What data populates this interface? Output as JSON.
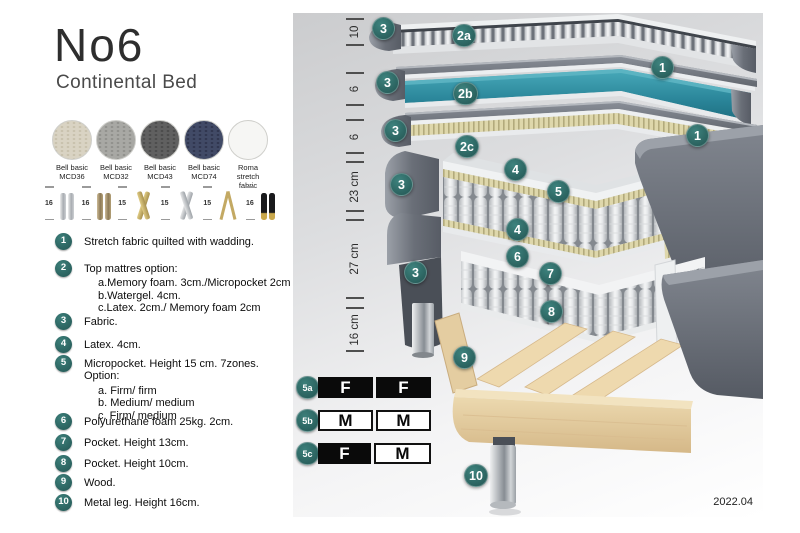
{
  "header": {
    "title": "No6",
    "subtitle": "Continental Bed"
  },
  "fabrics": [
    {
      "line1": "Bell basic",
      "line2": "MCD36",
      "color": "#d9d3c3"
    },
    {
      "line1": "Bell basic",
      "line2": "MCD32",
      "color": "#a8a8a4"
    },
    {
      "line1": "Bell basic",
      "line2": "MCD43",
      "color": "#606060"
    },
    {
      "line1": "Bell basic",
      "line2": "MCD74",
      "color": "#414a66"
    },
    {
      "line1": "Roma",
      "line2": "stretch fabric",
      "color": "#f6f6f4"
    }
  ],
  "legs": [
    {
      "height": "16",
      "type": "cylinder-silver"
    },
    {
      "height": "16",
      "type": "cylinder-bronze"
    },
    {
      "height": "15",
      "type": "cross-gold"
    },
    {
      "height": "15",
      "type": "cross-silver"
    },
    {
      "height": "15",
      "type": "hairpin-gold"
    },
    {
      "height": "16",
      "type": "tapered-black-gold"
    }
  ],
  "features": {
    "items": [
      {
        "num": "1",
        "text": "Stretch fabric quilted with wadding."
      },
      {
        "num": "2",
        "text": "Top mattres option:",
        "options": [
          "a.Memory foam. 3cm./Micropocket 2cm",
          "b.Watergel. 4cm.",
          "c.Latex. 2cm./ Memory foam 2cm"
        ]
      },
      {
        "num": "3",
        "text": "Fabric."
      },
      {
        "num": "4",
        "text": "Latex. 4cm."
      },
      {
        "num": "5",
        "text": "Micropocket. Height 15 cm. 7zones. Option:",
        "options": [
          "a. Firm/ firm",
          "b. Medium/ medium",
          "c. Firm/ medium"
        ]
      },
      {
        "num": "6",
        "text": "Polyurethane foam 25kg. 2cm."
      },
      {
        "num": "7",
        "text": "Pocket. Height 13cm."
      },
      {
        "num": "8",
        "text": "Pocket. Height 10cm."
      },
      {
        "num": "9",
        "text": "Wood."
      },
      {
        "num": "10",
        "text": "Metal leg. Height 16cm."
      }
    ]
  },
  "diagram": {
    "dimensions": [
      {
        "label": "10"
      },
      {
        "label": "6"
      },
      {
        "label": "6"
      },
      {
        "label": "23 cm"
      },
      {
        "label": "27 cm"
      },
      {
        "label": "16 cm"
      }
    ],
    "badges": [
      {
        "id": "fabric-top",
        "label": "3"
      },
      {
        "id": "top-option-a",
        "label": "2a"
      },
      {
        "id": "stretch-cover-a",
        "label": "1"
      },
      {
        "id": "fabric-mid",
        "label": "3"
      },
      {
        "id": "top-option-b",
        "label": "2b"
      },
      {
        "id": "stretch-cover-b",
        "label": "1"
      },
      {
        "id": "fabric-low",
        "label": "3"
      },
      {
        "id": "top-option-c",
        "label": "2c"
      },
      {
        "id": "latex-top",
        "label": "4"
      },
      {
        "id": "micropocket",
        "label": "5"
      },
      {
        "id": "fabric-23",
        "label": "3"
      },
      {
        "id": "latex-bottom",
        "label": "4"
      },
      {
        "id": "pu-foam",
        "label": "6"
      },
      {
        "id": "pocket-13",
        "label": "7"
      },
      {
        "id": "fabric-27",
        "label": "3"
      },
      {
        "id": "pocket-10",
        "label": "8"
      },
      {
        "id": "wood",
        "label": "9"
      },
      {
        "id": "metal-leg",
        "label": "10"
      }
    ]
  },
  "firmness": {
    "rows": [
      {
        "label": "5a",
        "cells": [
          {
            "value": "F",
            "style": "dark"
          },
          {
            "value": "F",
            "style": "dark"
          }
        ]
      },
      {
        "label": "5b",
        "cells": [
          {
            "value": "M",
            "style": "light"
          },
          {
            "value": "M",
            "style": "light"
          }
        ]
      },
      {
        "label": "5c",
        "cells": [
          {
            "value": "F",
            "style": "dark"
          },
          {
            "value": "M",
            "style": "light"
          }
        ]
      }
    ]
  },
  "footer": {
    "version": "2022.04"
  },
  "colors": {
    "badge_teal": "#2d6c69",
    "watergel_teal": "#2e8da0",
    "latex_beige": "#ded7ab",
    "cover_gray": "#6e737c",
    "wood": "#e7d2a6",
    "table_black": "#0a0a0a"
  }
}
